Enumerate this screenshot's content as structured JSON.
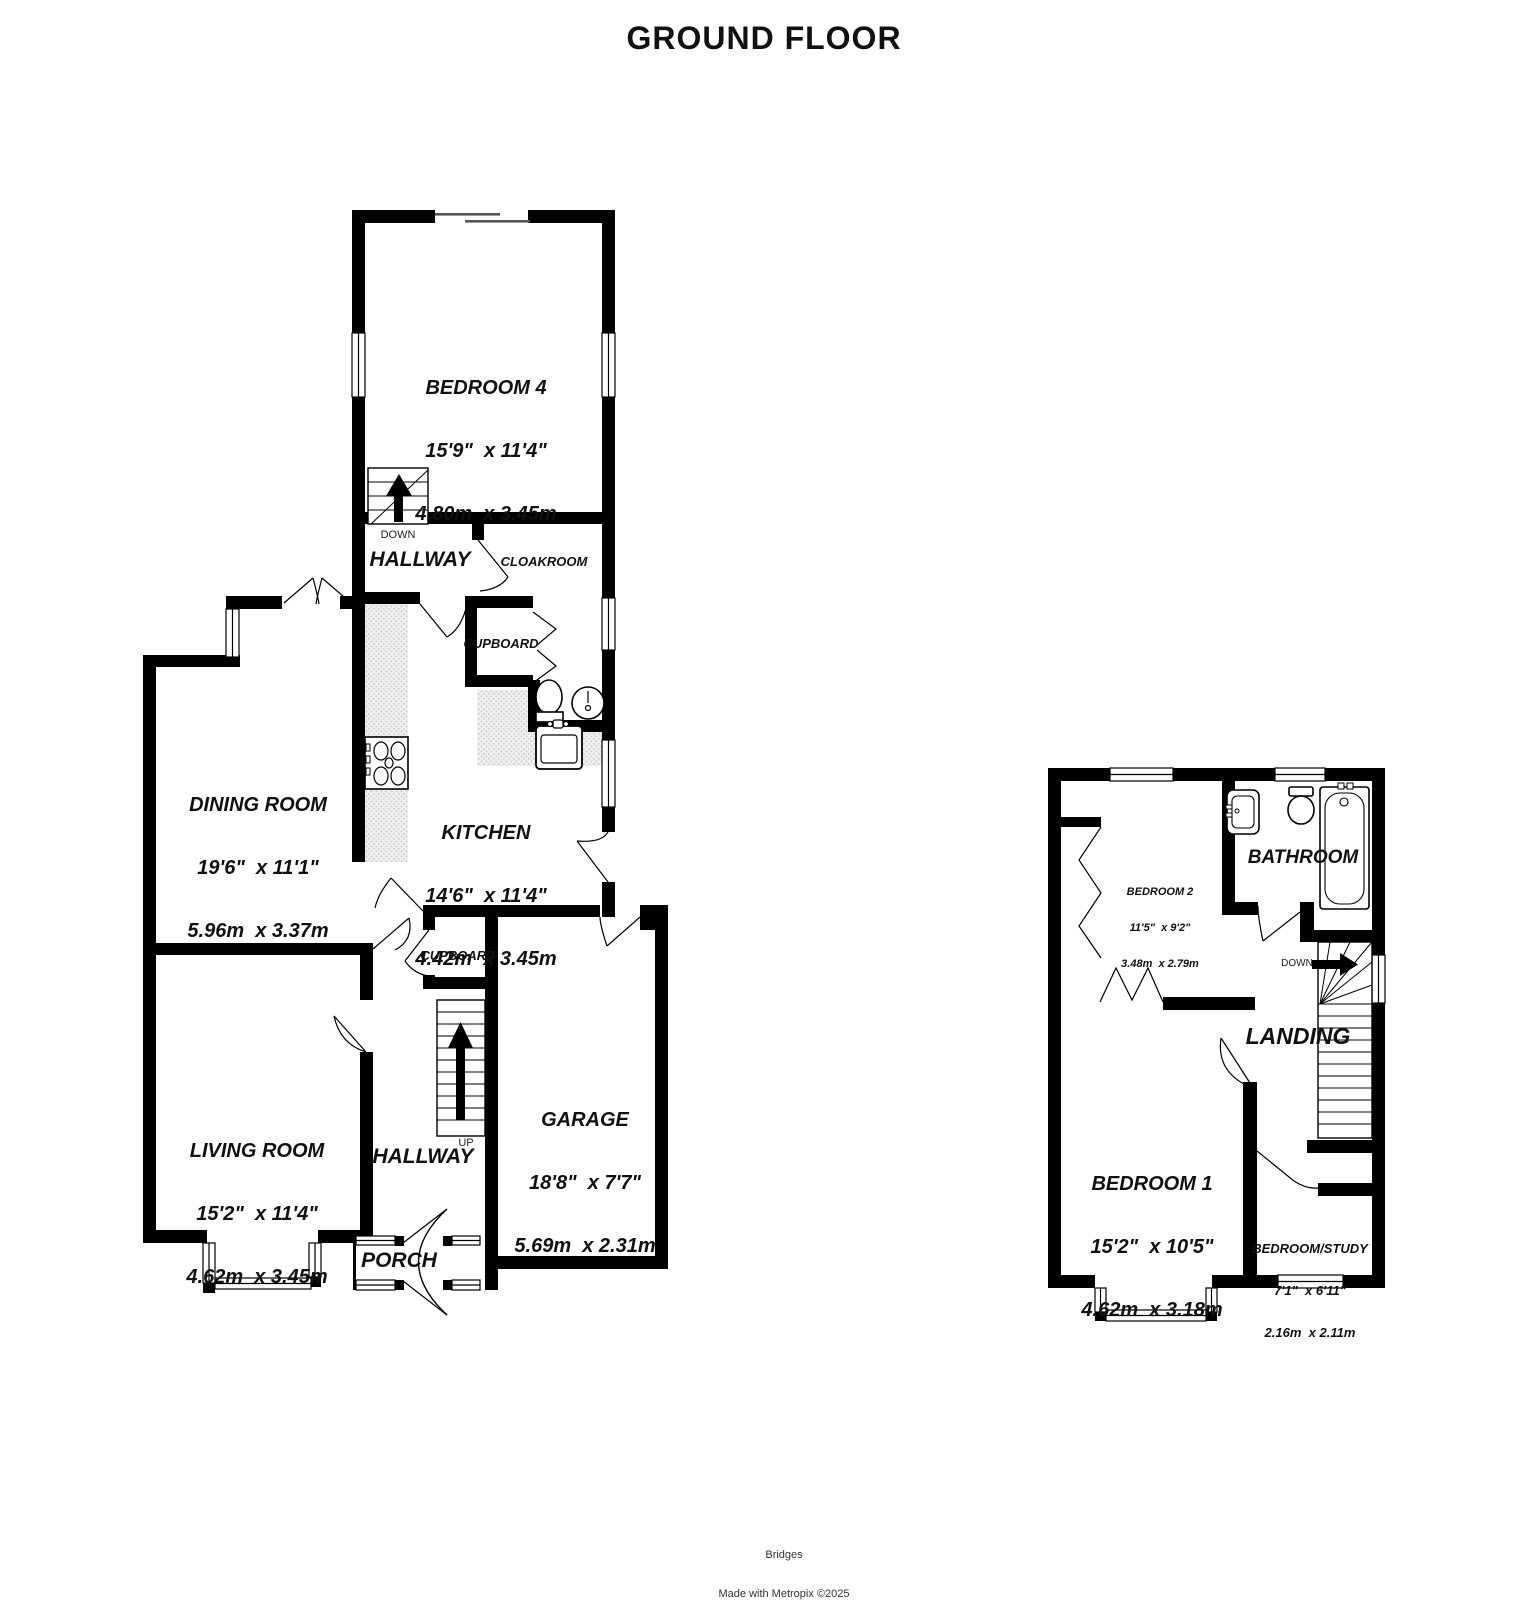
{
  "title": "GROUND FLOOR",
  "footer": {
    "brand": "Bridges",
    "credit": "Made with Metropix ©2025"
  },
  "labels": {
    "down_upper": "DOWN",
    "up_lower": "UP",
    "down_first": "DOWN"
  },
  "rooms": {
    "bedroom4": {
      "name": "BEDROOM 4",
      "imperial": "15'9\"  x 11'4\"",
      "metric": "4.80m  x 3.45m"
    },
    "hallway_upper": {
      "name": "HALLWAY"
    },
    "cloakroom": {
      "name": "CLOAKROOM"
    },
    "cupboard_upper": {
      "name": "CUPBOARD"
    },
    "dining_room": {
      "name": "DINING ROOM",
      "imperial": "19'6\"  x 11'1\"",
      "metric": "5.96m  x 3.37m"
    },
    "kitchen": {
      "name": "KITCHEN",
      "imperial": "14'6\"  x 11'4\"",
      "metric": "4.42m  x 3.45m"
    },
    "living_room": {
      "name": "LIVING ROOM",
      "imperial": "15'2\"  x 11'4\"",
      "metric": "4.62m  x 3.45m"
    },
    "hallway_lower": {
      "name": "HALLWAY"
    },
    "cupboard_lower": {
      "name": "CUPBOARD"
    },
    "garage": {
      "name": "GARAGE",
      "imperial": "18'8\"  x 7'7\"",
      "metric": "5.69m  x 2.31m"
    },
    "porch": {
      "name": "PORCH"
    },
    "bedroom2": {
      "name": "BEDROOM 2",
      "imperial": "11'5\"  x 9'2\"",
      "metric": "3.48m  x 2.79m"
    },
    "bathroom": {
      "name": "BATHROOM"
    },
    "landing": {
      "name": "LANDING"
    },
    "bedroom1": {
      "name": "BEDROOM 1",
      "imperial": "15'2\"  x 10'5\"",
      "metric": "4.62m  x 3.18m"
    },
    "bedroom_study": {
      "name": "BEDROOM/STUDY",
      "imperial": "7'1\"  x 6'11\"",
      "metric": "2.16m  x 2.11m"
    }
  },
  "colors": {
    "wall": "#000000",
    "background": "#ffffff",
    "counter_dot": "#c9c9c9",
    "text": "#111111"
  }
}
